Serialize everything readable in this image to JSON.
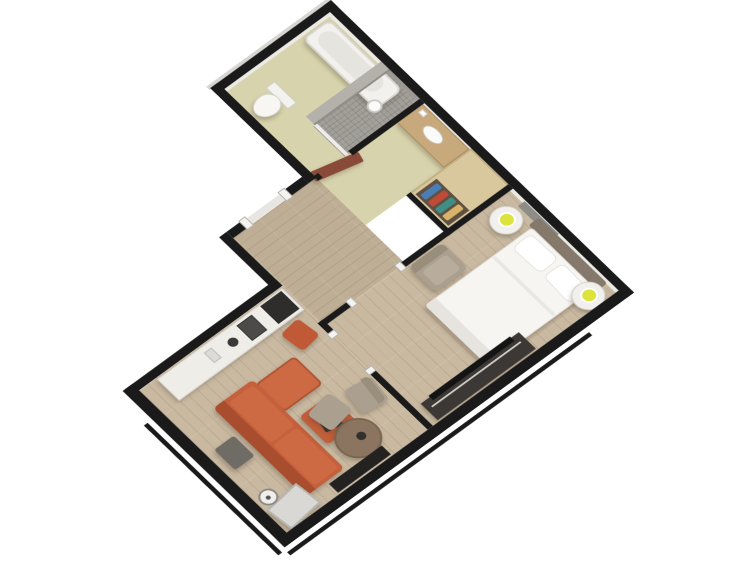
{
  "scene": {
    "type": "3d-floorplan-render",
    "description": "Isometric 3D cutaway floor plan of a one-bedroom hotel suite on a white background, rotated diamond orientation, black wall tops",
    "rooms": [
      {
        "name": "bathroom",
        "floor": "pale-khaki tile",
        "furniture": [
          "bathtub",
          "toilet",
          "walk-in-shower",
          "shower-pendant-light"
        ]
      },
      {
        "name": "vanity-nook",
        "floor": "pale-khaki tile",
        "furniture": [
          "wood-vanity-counter",
          "oval-sink",
          "mirror"
        ]
      },
      {
        "name": "closet",
        "furniture": [
          "open-wardrobe-with-clothes"
        ]
      },
      {
        "name": "bedroom",
        "floor": "light-wood-plank",
        "furniture": [
          "double-bed-white-linen",
          "headboard",
          "nightstand-west-with-lamp",
          "nightstand-east-with-lamp",
          "armchair",
          "tv-console",
          "wall-vent"
        ]
      },
      {
        "name": "hallway",
        "floor": "light-wood-plank",
        "furniture": [
          "open-bathroom-door",
          "entry-doorway"
        ]
      },
      {
        "name": "living-room",
        "floor": "light-wood-plank",
        "furniture": [
          "kitchenette-counter",
          "microwave",
          "appliances",
          "orange-ottoman-stool",
          "terracotta-sectional-sofa",
          "sofa-chaise",
          "ottoman-with-tray",
          "gray-cube-stool",
          "round-table",
          "two-armchairs",
          "media-console",
          "leaning-mirror",
          "floor-lamp"
        ]
      }
    ],
    "palette": {
      "wallTop": "#1a1a1a",
      "wallFace": "#eceae5",
      "bathFloor": "#d7d3ac",
      "showerWall": "#b4b1ab",
      "counterWood": "#c8a97b",
      "bedWhite": "#f6f5f2",
      "headboard": "#84796b",
      "sofa": "#c4603c",
      "sofaBack": "#a84d2e",
      "sofaCushion": "#cd6a44",
      "stool": "#c05a36",
      "taupeChair": "#ab9f8f",
      "wardrobe": "#d9c79e",
      "wardrobeInner": "#5f5142",
      "doorLeaf": "#8a4a3a",
      "kitchenCounter": "#efede8",
      "console": "#3b3835",
      "tvBlack": "#141414",
      "lampGlow": "#dce33c",
      "tableWood": "#8b7560",
      "vent": "#8e8c86",
      "mirror": "#d9d8d4",
      "grayCube": "#6f6c66",
      "clothes": [
        "#4a7fb5",
        "#bf4a38",
        "#3f8f87",
        "#d9b36a"
      ]
    }
  }
}
